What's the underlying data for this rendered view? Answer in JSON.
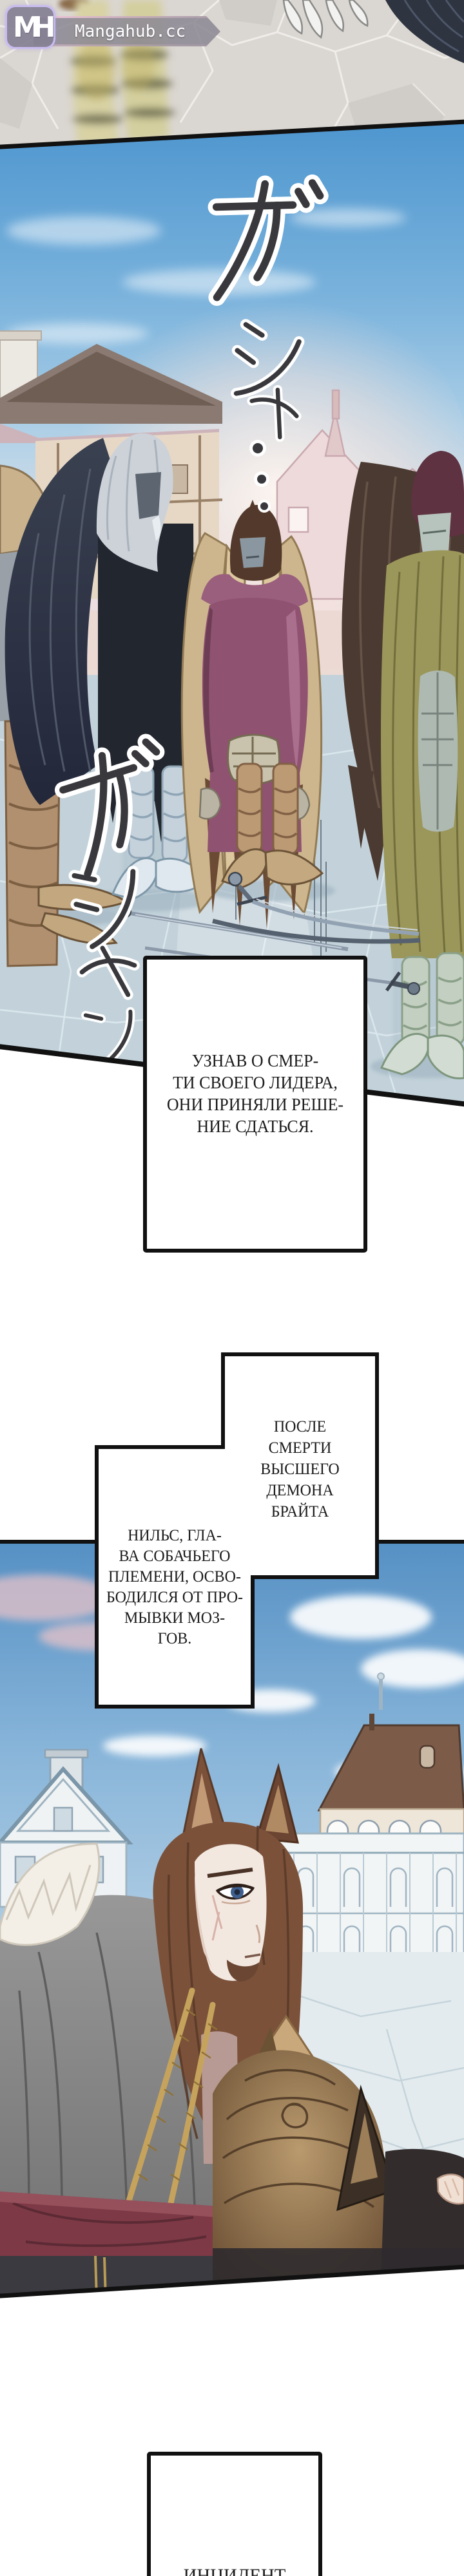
{
  "watermark": {
    "monogram": "MH",
    "site_name": "Mangahub.cc"
  },
  "sound_effects": {
    "top_vertical": "ガシャ…",
    "left_vertical": "ガシャン"
  },
  "narration": {
    "surrender_box": {
      "lines": [
        "УЗНАВ О СМЕР-",
        "ТИ СВОЕГО ЛИДЕРА,",
        "ОНИ ПРИНЯЛИ РЕШЕ-",
        "НИЕ СДАТЬСЯ."
      ]
    },
    "after_death_box": {
      "lines": [
        "ПОСЛЕ",
        "СМЕРТИ",
        "ВЫСШЕГО",
        "ДЕМОНА",
        "БРАЙТА"
      ]
    },
    "nils_box": {
      "lines": [
        "НИЛЬС, ГЛА-",
        "ВА СОБАЧЬЕГО",
        "ПЛЕМЕНИ, ОСВО-",
        "БОДИЛСЯ ОТ ПРО-",
        "МЫВКИ МОЗ-",
        "ГОВ."
      ]
    },
    "incident_box": {
      "lines": [
        "ИНЦИДЕНТ"
      ]
    }
  },
  "palette": {
    "paper": "#ffffff",
    "ink": "#111111",
    "text": "#1c1c1c",
    "sky_top": "#4e96cf",
    "sky_pink": "#f6e7e3",
    "plaza_floor": "#c3d2da",
    "logo_border": "#c9bcf0",
    "banner_accent": "#f2c6da",
    "sfx_ink": "#39393d",
    "sfx_casing": "#ffffff"
  }
}
